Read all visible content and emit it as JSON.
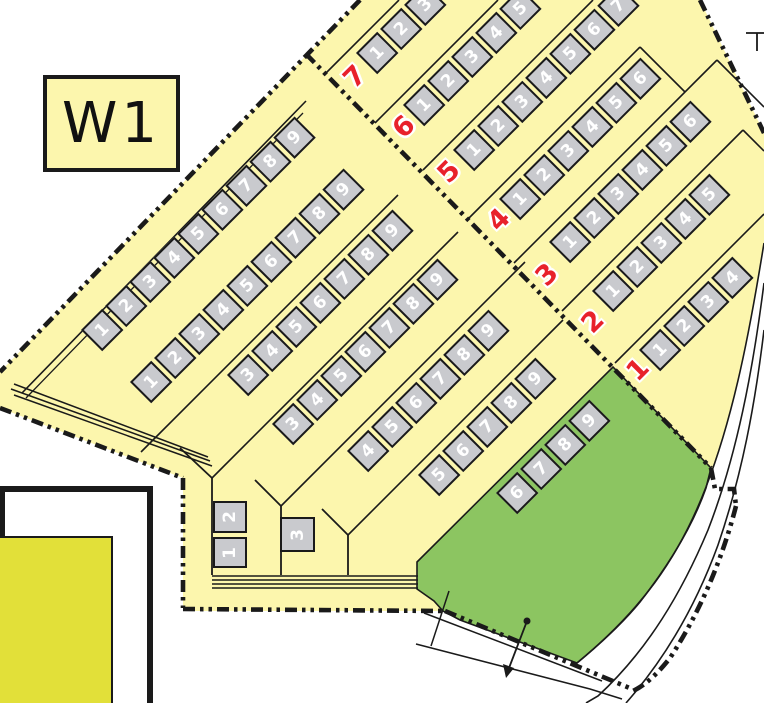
{
  "section": {
    "label": "W1"
  },
  "colors": {
    "area_yellow": "#FCF6AD",
    "lawn_green": "#8CC561",
    "adjacent_yellow_green": "#E2E039",
    "plot_gray": "#C9CACE",
    "row_number_red": "#E8212B",
    "line_black": "#1a1a1a"
  },
  "left_rows": [
    {
      "id": "L1",
      "plots": [
        "1",
        "2",
        "3",
        "4",
        "5",
        "6",
        "7",
        "8",
        "9"
      ]
    },
    {
      "id": "L2",
      "plots": [
        "1",
        "2",
        "3",
        "4",
        "5",
        "6",
        "7",
        "8",
        "9"
      ]
    },
    {
      "id": "L3",
      "plots": [
        "3",
        "4",
        "5",
        "6",
        "7",
        "8",
        "9"
      ]
    },
    {
      "id": "L4",
      "plots": [
        "3",
        "4",
        "5",
        "6",
        "7",
        "8",
        "9"
      ]
    },
    {
      "id": "L5",
      "plots": [
        "4",
        "5",
        "6",
        "7",
        "8",
        "9"
      ]
    },
    {
      "id": "L6",
      "plots": [
        "5",
        "6",
        "7",
        "8",
        "9"
      ]
    },
    {
      "id": "L7",
      "plots": [
        "6",
        "7",
        "8",
        "9"
      ]
    }
  ],
  "right_rows": [
    {
      "id": "R7",
      "plots": [
        "1",
        "2",
        "3"
      ]
    },
    {
      "id": "R6",
      "plots": [
        "1",
        "2",
        "3",
        "4",
        "5"
      ]
    },
    {
      "id": "R5",
      "plots": [
        "1",
        "2",
        "3",
        "4",
        "5",
        "6",
        "7"
      ]
    },
    {
      "id": "R4",
      "plots": [
        "1",
        "2",
        "3",
        "4",
        "5",
        "6"
      ]
    },
    {
      "id": "R3",
      "plots": [
        "1",
        "2",
        "3",
        "4",
        "5",
        "6"
      ]
    },
    {
      "id": "R2",
      "plots": [
        "1",
        "2",
        "3",
        "4",
        "5"
      ]
    },
    {
      "id": "R1",
      "plots": [
        "1",
        "2",
        "3",
        "4"
      ]
    }
  ],
  "corner_plots": [
    {
      "id": "C2",
      "label": "2"
    },
    {
      "id": "C1",
      "label": "1"
    },
    {
      "id": "C3",
      "label": "3"
    }
  ],
  "row_number_labels": [
    "7",
    "6",
    "5",
    "4",
    "3",
    "2",
    "1"
  ]
}
